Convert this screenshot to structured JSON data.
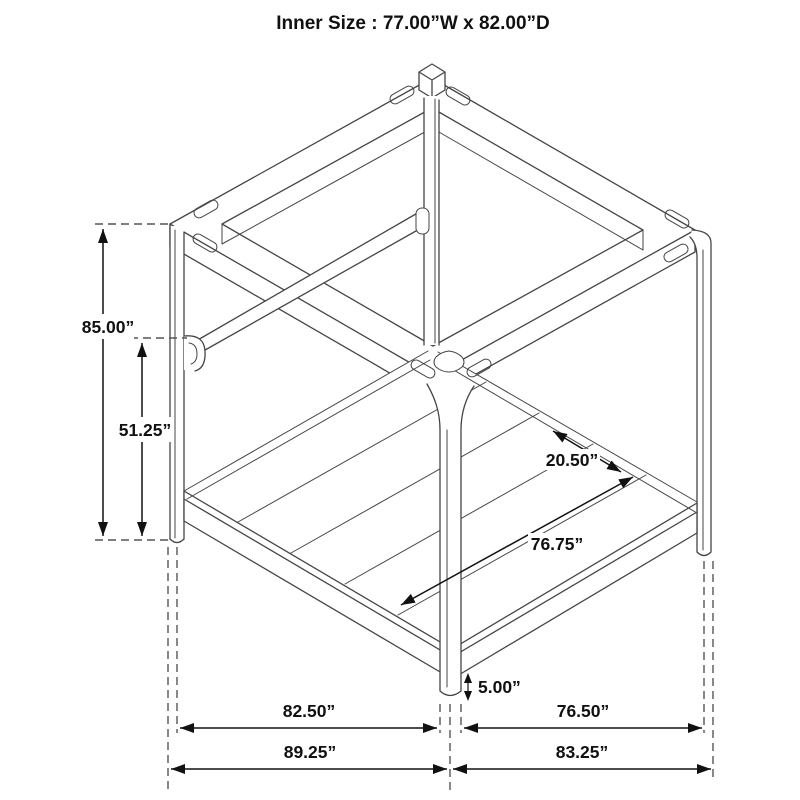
{
  "title": "Inner Size : 77.00”W x 82.00”D",
  "diagram": {
    "subject": "canopy-bed-frame-isometric-line-drawing",
    "dims": {
      "height": "85.00”",
      "rail_height": "51.25”",
      "slat_gap": "20.50”",
      "inner_depth_top": "76.75”",
      "floor_clearance": "5.00”",
      "inner_width": "82.50”",
      "inner_depth_bottom": "76.50”",
      "outer_width": "89.25”",
      "outer_depth": "83.25”"
    },
    "colors": {
      "line": "#454545",
      "dimension": "#111111",
      "background": "#ffffff"
    }
  }
}
